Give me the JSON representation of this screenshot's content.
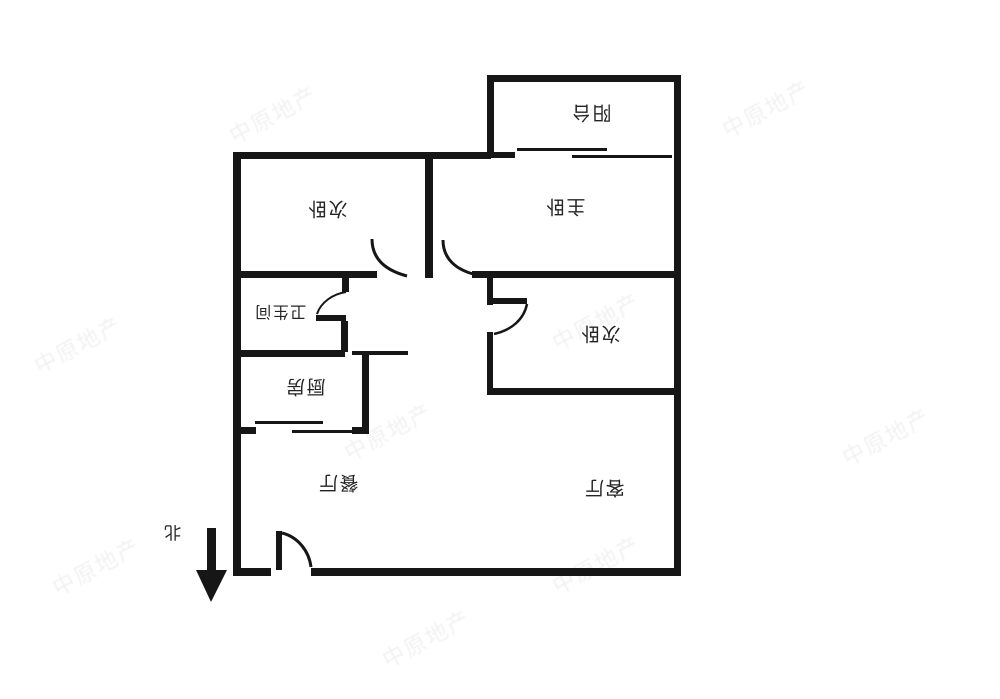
{
  "compass": {
    "label": "北"
  },
  "rooms": {
    "balcony": {
      "label": "阳台"
    },
    "master_bedroom": {
      "label": "主卧"
    },
    "bedroom_left": {
      "label": "次卧"
    },
    "bedroom_right": {
      "label": "次卧"
    },
    "bathroom": {
      "label": "卫生间"
    },
    "kitchen": {
      "label": "厨房"
    },
    "dining": {
      "label": "餐厅"
    },
    "living": {
      "label": "客厅"
    }
  },
  "watermark": {
    "text": "中原地产"
  },
  "colors": {
    "wall": "#161616",
    "label": "#242424"
  }
}
